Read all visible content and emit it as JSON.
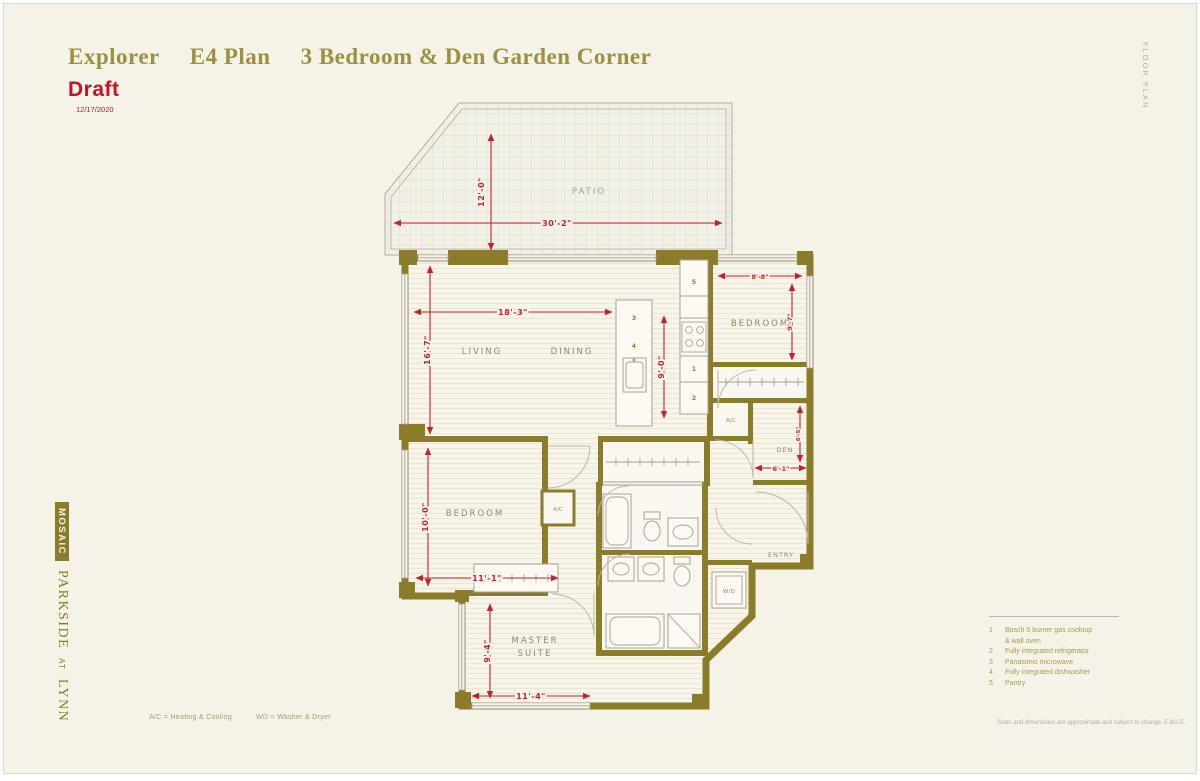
{
  "header": {
    "title_name": "Explorer",
    "title_plan": "E4 Plan",
    "title_desc": "3 Bedroom & Den Garden Corner",
    "draft": "Draft",
    "date": "12/17/2020"
  },
  "meta": {
    "floor_plan_tag": "FLOOR PLAN"
  },
  "brand": {
    "mosaic": "MOSAIC",
    "parkside": "PARKSIDE",
    "at": "AT",
    "lynn": "LYNN"
  },
  "rooms": {
    "patio": "PATIO",
    "living": "LIVING",
    "dining": "DINING",
    "bedroom_upper": "BEDROOM",
    "bedroom_left": "BEDROOM",
    "master_line1": "MASTER",
    "master_line2": "SUITE",
    "den": "DEN",
    "entry": "ENTRY",
    "ac": "A/C",
    "wd": "W/D"
  },
  "dims": {
    "patio_depth": "12'-0\"",
    "patio_width": "30'-2\"",
    "living_width": "18'-3\"",
    "living_depth": "16'-7\"",
    "kitchen_depth": "9'-0\"",
    "bedroom_upper_width": "8'-8\"",
    "bedroom_upper_depth": "9'-7\"",
    "den_width": "6'-1\"",
    "den_depth": "6'-5\"",
    "bedroom_left_depth": "10'-0\"",
    "bedroom_left_width": "11'-1\"",
    "master_depth": "9'-4\"",
    "master_width": "11'-4\""
  },
  "appliances": {
    "a1": "1",
    "a2": "2",
    "a3": "3",
    "a4": "4",
    "a5": "5"
  },
  "legend": {
    "items": [
      {
        "num": "1",
        "line1": "Bosch 5 burner gas cooktop",
        "line2": "& wall oven"
      },
      {
        "num": "2",
        "line1": "Fully integrated refrigerator"
      },
      {
        "num": "3",
        "line1": "Panasonic microwave"
      },
      {
        "num": "4",
        "line1": "Fully integrated dishwasher"
      },
      {
        "num": "5",
        "line1": "Pantry"
      }
    ]
  },
  "footer": {
    "ac_note": "A/C = Heating & Cooling",
    "wd_note": "WD = Washer & Dryer",
    "disclaimer": "Sizes and dimensions are approximate and subject to change. E.&O.E."
  },
  "colors": {
    "background": "#f5f2e8",
    "wall_olive": "#8a7c28",
    "title_olive": "#9d9140",
    "accent_red": "#c2222a"
  }
}
